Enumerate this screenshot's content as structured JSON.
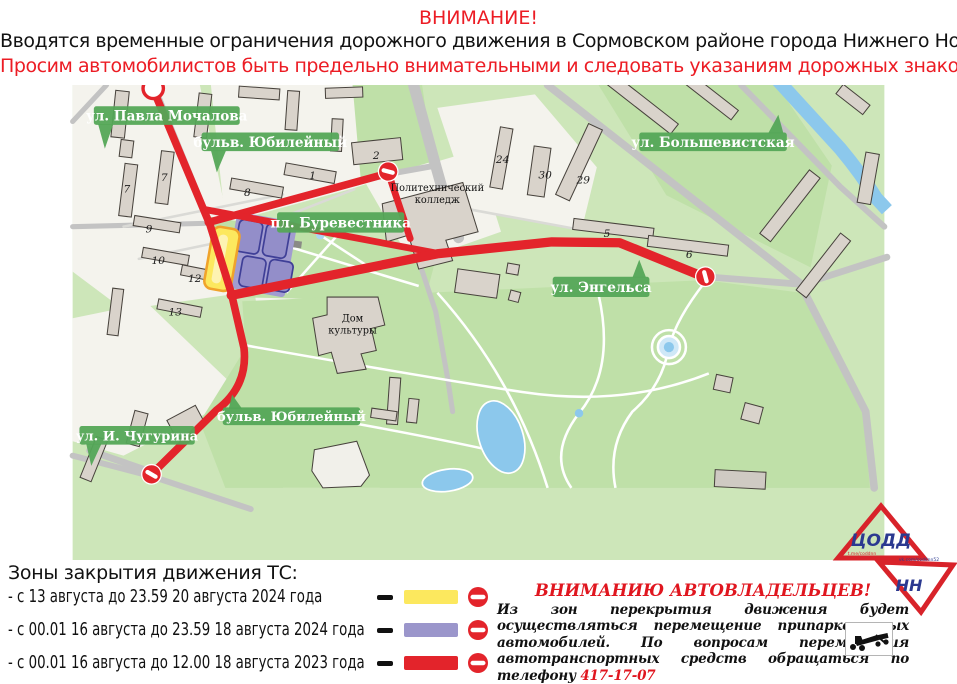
{
  "header": {
    "line1": "ВНИМАНИЕ!",
    "line2": "Вводятся временные ограничения дорожного движения в Сормовском районе города Нижнего Новгорода.",
    "line3": "Просим автомобилистов быть предельно внимательными и следовать указаниям дорожных знаков."
  },
  "map": {
    "street_labels": {
      "pavla_mochalova": "ул. Павла Мочалова",
      "yubileyny_top": "бульв. Юбилейный",
      "bolshevistskaya": "ул. Большевистская",
      "burevestnika": "пл. Буревестника",
      "engelsa": "ул. Энгельса",
      "yubileyny_bottom": "бульв. Юбилейный",
      "chugurina": "ул. И. Чугурина"
    },
    "place_labels": {
      "college_line1": "Политехнический",
      "college_line2": "колледж",
      "dk_line1": "Дом",
      "dk_line2": "культуры"
    },
    "building_numbers": {
      "b7a": "7",
      "b7b": "7",
      "b8": "8",
      "b9": "9",
      "b10": "10",
      "b12": "12",
      "b13": "13",
      "b1": "1",
      "b2": "2",
      "b24": "24",
      "b30": "30",
      "b29": "29",
      "b5": "5",
      "b6": "6"
    },
    "colors": {
      "route_red": "#e3242b",
      "zone_yellow": "#fce85e",
      "zone_yellow_border": "#f0a32b",
      "zone_purple": "#9b96cb",
      "badge_green": "#54a657",
      "park_green": "#bfe0a8",
      "block_white": "#f4f3ed",
      "road_gray": "#c3c3c3",
      "water_blue": "#8cc8ec"
    }
  },
  "legend": {
    "title": "Зоны закрытия движения ТС:",
    "rows": [
      {
        "label": "- с 13 августа до 23.59 20 августа 2024 года",
        "color": "#fce85e"
      },
      {
        "label": "- с 00.01 16 августа до 23.59 18 августа 2024 года",
        "color": "#9b96cb"
      },
      {
        "label": "- с 00.01 16 августа до 12.00 18 августа 2023 года",
        "color": "#e3242b"
      }
    ]
  },
  "notice": {
    "title": "ВНИМАНИЮ АВТОВЛАДЕЛЬЦЕВ!",
    "body": "Из зон перекрытия движения будет осуществляться перемещение припаркованных автомобилей.  По вопросам перемещения автотранспортных средств обращаться по телефону ",
    "phone": "417-17-07"
  },
  "logo": {
    "top": "ЦОДД",
    "bottom": "НН",
    "link_top": "t.me/coddnn",
    "link_bottom": "vk.com/coddnn52"
  }
}
